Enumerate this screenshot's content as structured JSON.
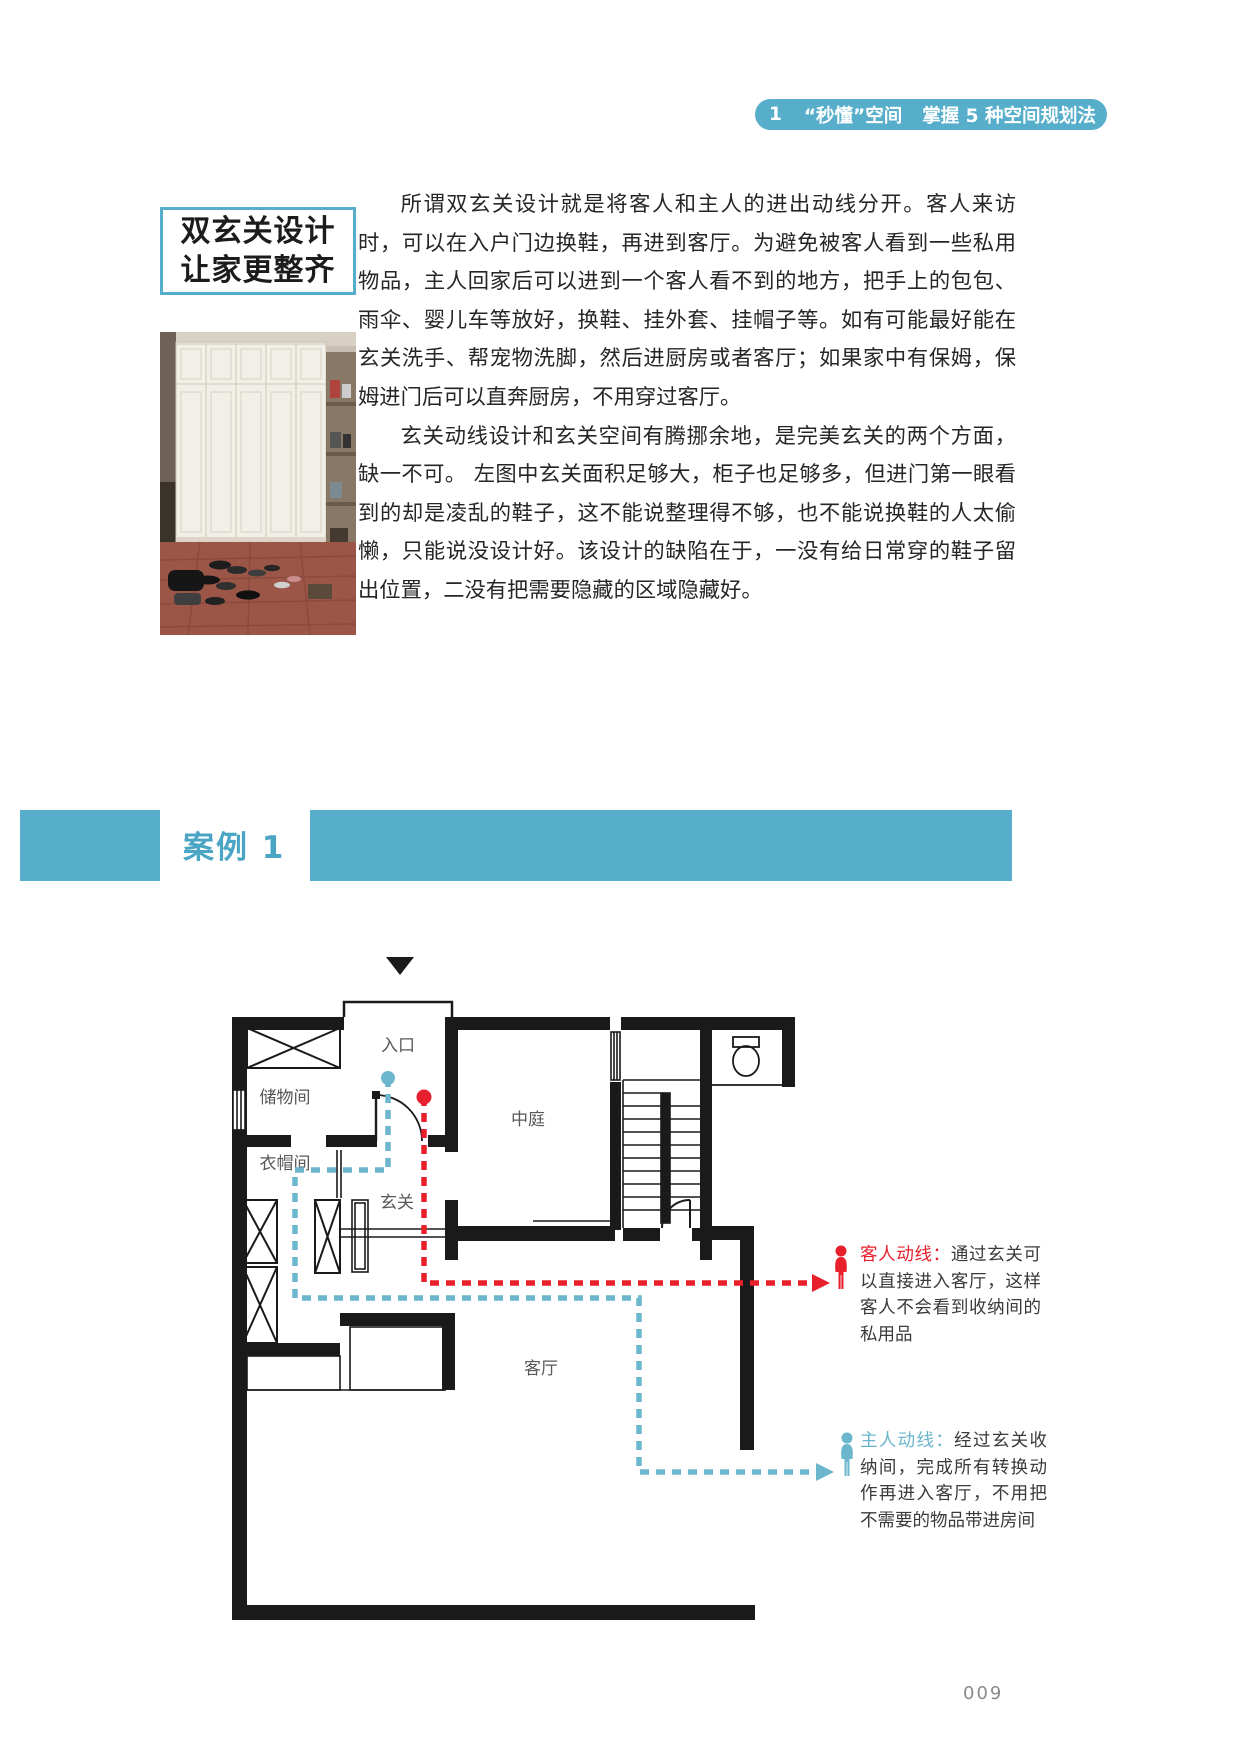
{
  "header": {
    "chapter_num": "1",
    "title_a": "“秒懂”空间",
    "title_b": "掌握 5 种空间规划法"
  },
  "sidebar": {
    "box_title_line1": "双玄关设计",
    "box_title_line2": "让家更整齐"
  },
  "article": {
    "para1": "所谓双玄关设计就是将客人和主人的进出动线分开。客人来访时，可以在入户门边换鞋，再进到客厅。为避免被客人看到一些私用物品，主人回家后可以进到一个客人看不到的地方，把手上的包包、雨伞、婴儿车等放好，换鞋、挂外套、挂帽子等。如有可能最好能在玄关洗手、帮宠物洗脚，然后进厨房或者客厅；如果家中有保姆，保姆进门后可以直奔厨房，不用穿过客厅。",
    "para2": "玄关动线设计和玄关空间有腾挪余地，是完美玄关的两个方面，缺一不可。 左图中玄关面积足够大，柜子也足够多，但进门第一眼看到的却是凌乱的鞋子，这不能说整理得不够，也不能说换鞋的人太偷懒，只能说没设计好。该设计的缺陷在于，一没有给日常穿的鞋子留出位置，二没有把需要隐藏的区域隐藏好。"
  },
  "case_banner": {
    "label": "案例 1"
  },
  "plan": {
    "entry_label": "入口",
    "storage_label": "储物间",
    "cloak_label": "衣帽间",
    "hall_label": "玄关",
    "atrium_label": "中庭",
    "living_label": "客厅",
    "guest_route_label": "客人动线：",
    "guest_route_text": "通过玄关可以直接进入客厅，这样客人不会看到收纳间的私用品",
    "owner_route_label": "主人动线：",
    "owner_route_text": "经过玄关收纳间，完成所有转换动作再进入客厅，不用把不需要的物品带进房间"
  },
  "footer": {
    "page_number": "009"
  },
  "colors": {
    "accent": "#56AECB",
    "route_red": "#E8202D",
    "route_blue": "#6CB6CE"
  }
}
